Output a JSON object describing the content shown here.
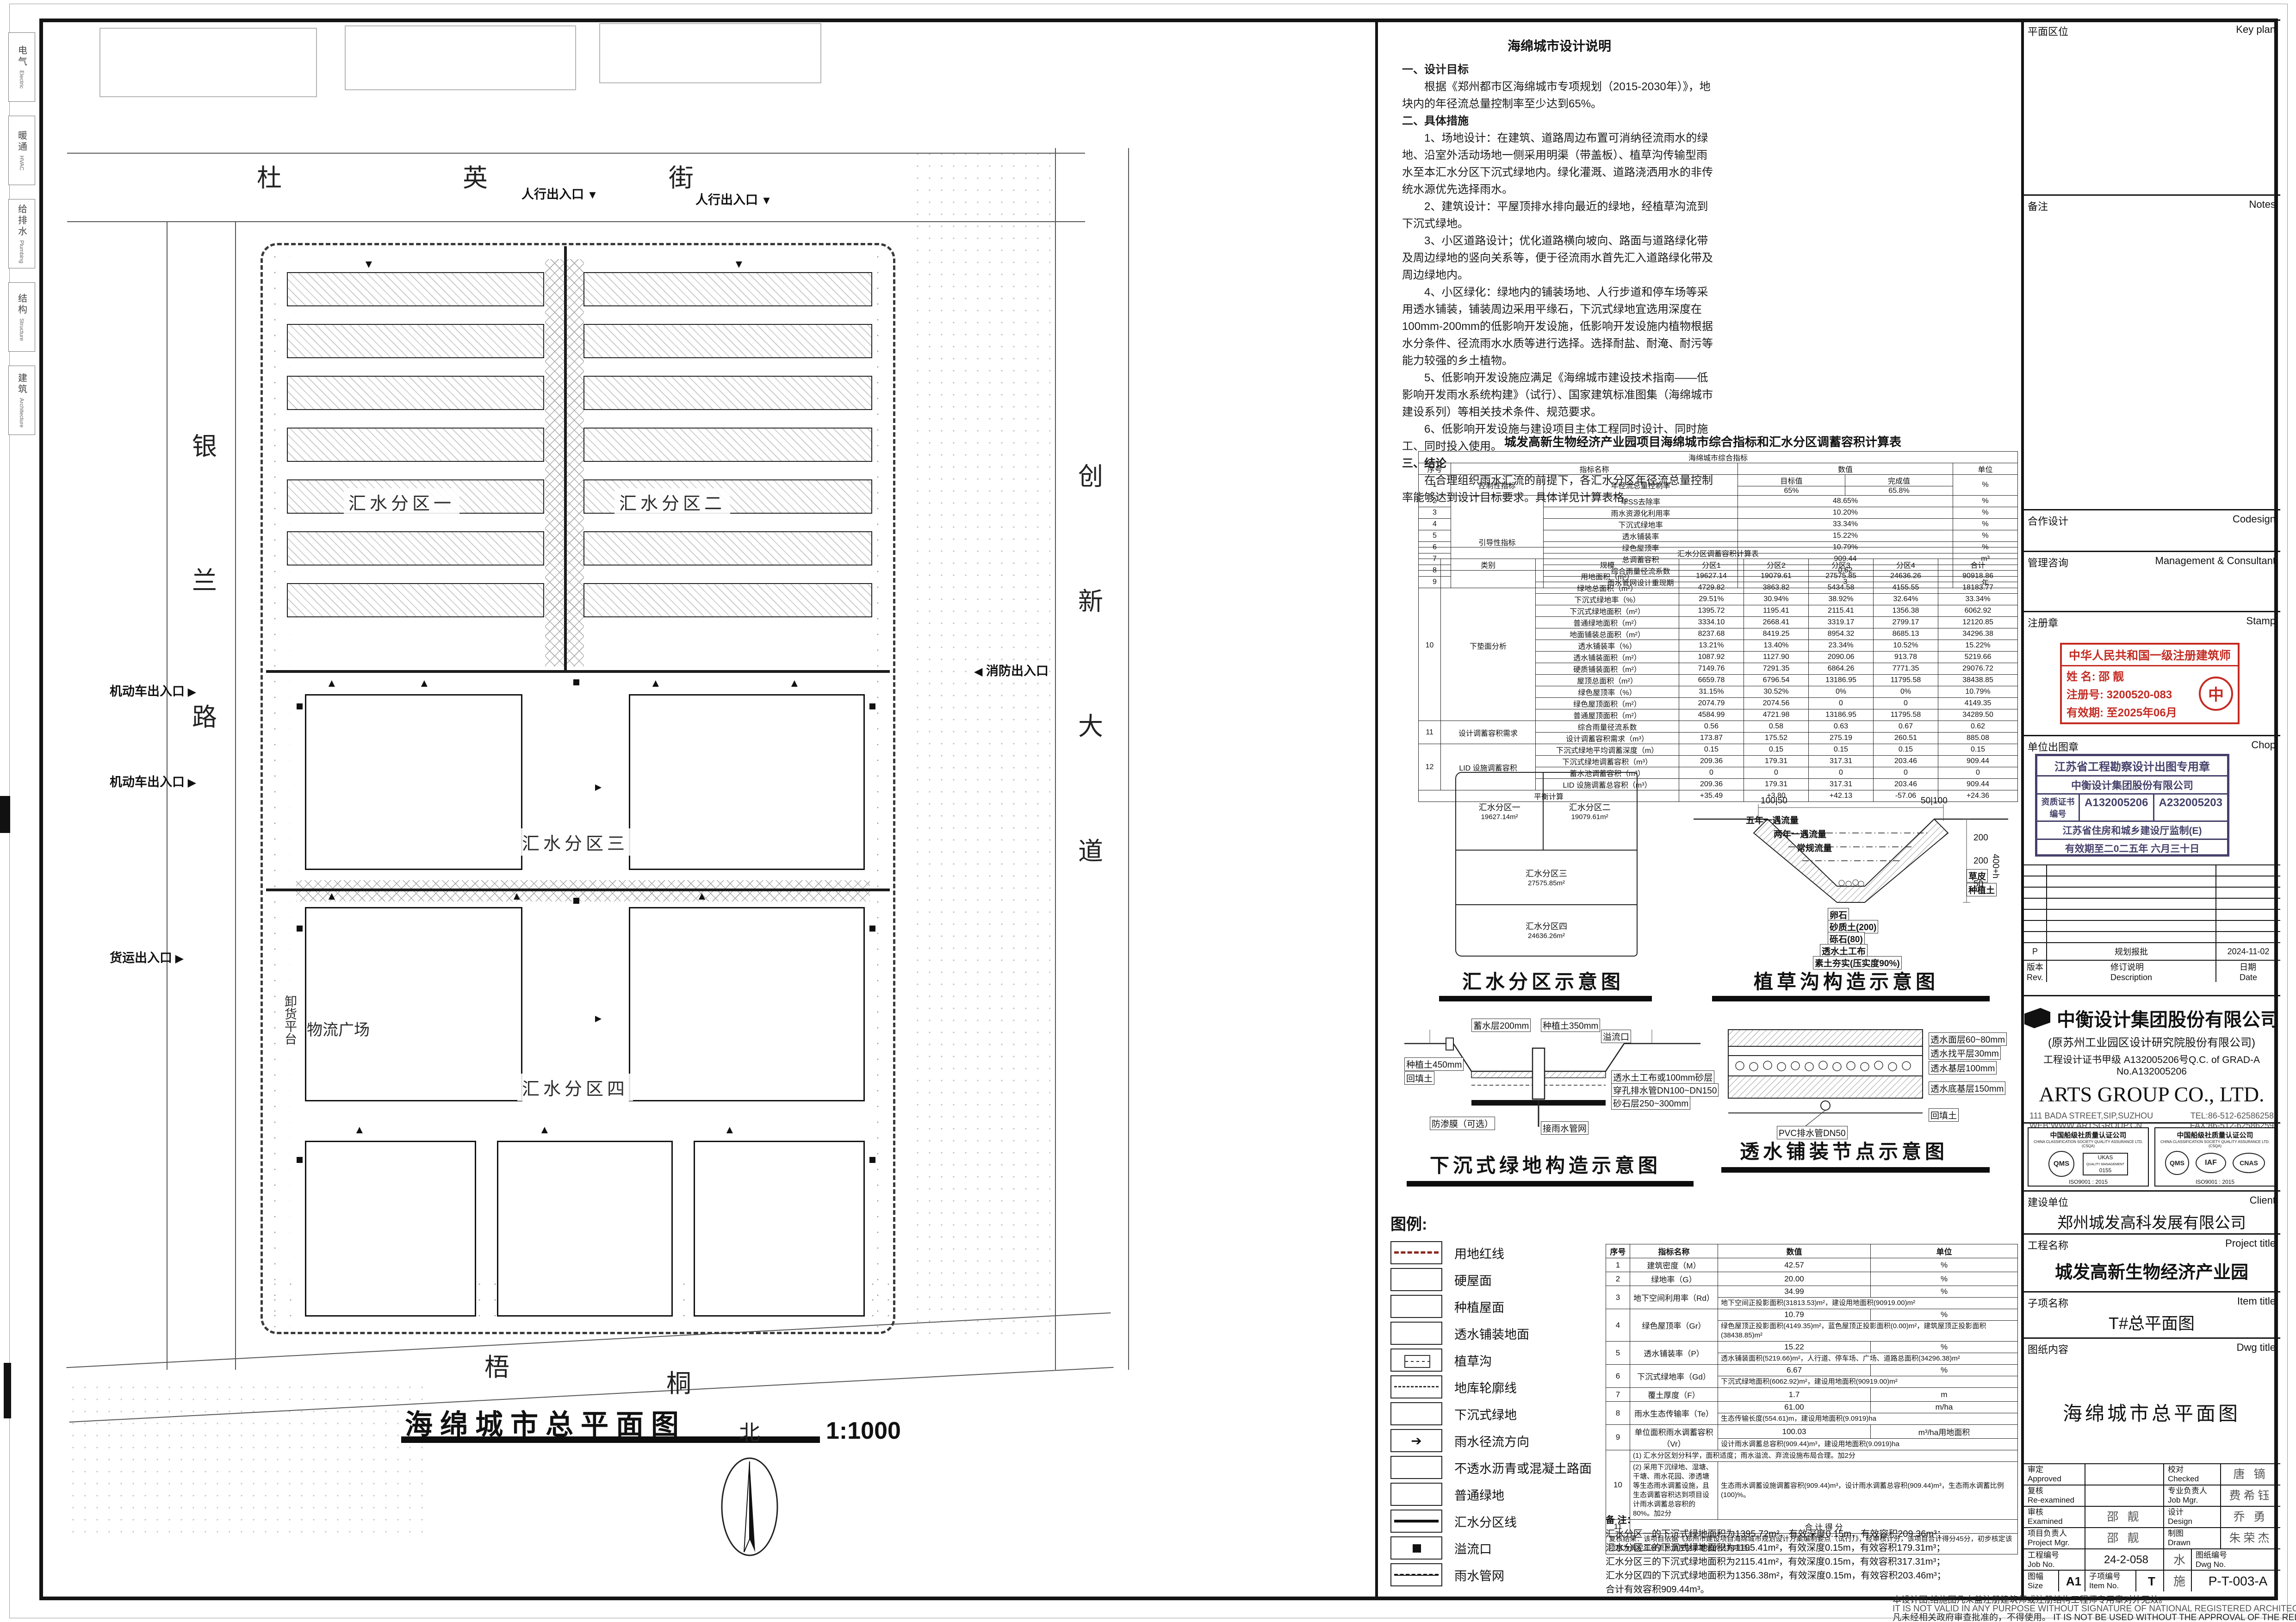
{
  "margin": {
    "disciplines": [
      {
        "cn": "电气",
        "en": "Electric"
      },
      {
        "cn": "暖通",
        "en": "HVAC"
      },
      {
        "cn": "给排水",
        "en": "Plumbing"
      },
      {
        "cn": "结构",
        "en": "Structure"
      },
      {
        "cn": "建筑",
        "en": "Architecture"
      }
    ]
  },
  "plan": {
    "title": "海绵城市总平面图",
    "scale": "1:1000",
    "north": "北",
    "streets": {
      "top": [
        "杜",
        "英",
        "街"
      ],
      "left": [
        "银",
        "兰",
        "路"
      ],
      "right": [
        "创",
        "新",
        "大",
        "道"
      ],
      "bottom": [
        "梧",
        "桐"
      ]
    },
    "zones": [
      "汇水分区一",
      "汇水分区二",
      "汇水分区三",
      "汇水分区四"
    ],
    "site_labels": [
      "物流广场",
      "卸货平台"
    ],
    "entrances": [
      "人行出入口",
      "人行出入口",
      "消防出入口",
      "机动车出入口",
      "机动车出入口",
      "货运出入口"
    ]
  },
  "notes": {
    "title": "海绵城市设计说明",
    "paragraphs": [
      {
        "h": true,
        "text": "一、设计目标"
      },
      {
        "h": false,
        "text": "根据《郑州都市区海绵城市专项规划（2015-2030年）》，地块内的年径流总量控制率至少达到65%。"
      },
      {
        "h": true,
        "text": "二、具体措施"
      },
      {
        "h": false,
        "text": "1、场地设计：在建筑、道路周边布置可消纳径流雨水的绿地、沿室外活动场地一侧采用明渠（带盖板）、植草沟传输型雨水至本汇水分区下沉式绿地内。绿化灌溉、道路浇洒用水的非传统水源优先选择雨水。"
      },
      {
        "h": false,
        "text": "2、建筑设计：平屋顶排水排向最近的绿地，经植草沟流到下沉式绿地。"
      },
      {
        "h": false,
        "text": "3、小区道路设计；优化道路横向坡向、路面与道路绿化带及周边绿地的竖向关系等，便于径流雨水首先汇入道路绿化带及周边绿地内。"
      },
      {
        "h": false,
        "text": "4、小区绿化：绿地内的铺装场地、人行步道和停车场等采用透水铺装，铺装周边采用平缘石，下沉式绿地宜选用深度在100mm-200mm的低影响开发设施，低影响开发设施内植物根据水分条件、径流雨水水质等进行选择。选择耐盐、耐淹、耐污等能力较强的乡土植物。"
      },
      {
        "h": false,
        "text": "5、低影响开发设施应满足《海绵城市建设技术指南——低影响开发雨水系统构建》（试行）、国家建筑标准图集（海绵城市建设系列）等相关技术条件、规范要求。"
      },
      {
        "h": false,
        "text": "6、低影响开发设施与建设项目主体工程同时设计、同时施工、同时投入使用。"
      },
      {
        "h": true,
        "text": "三、结论"
      },
      {
        "h": false,
        "text": "在合理组织雨水汇流的前提下，各汇水分区年径流总量控制率能够达到设计目标要求。具体详见计算表格。"
      }
    ]
  },
  "tables": {
    "main_title": "城发高新生物经济产业园项目海绵城市综合指标和汇水分区调蓄容积计算表",
    "indicator": {
      "section_title": "海绵城市综合指标",
      "headers": [
        "序号",
        "指标名称",
        "数值",
        "单位"
      ],
      "sub_headers": [
        "目标值",
        "完成值"
      ],
      "rows": [
        {
          "no": "1",
          "cat": "控制性指标",
          "name": "年径流总量控制率",
          "target": "65%",
          "done": "65.8%",
          "unit": "%"
        },
        {
          "no": "2",
          "cat": "引导性指标",
          "name": "年SS去除率",
          "value": "48.65%",
          "unit": "%"
        },
        {
          "no": "3",
          "name": "雨水资源化利用率",
          "value": "10.20%",
          "unit": "%"
        },
        {
          "no": "4",
          "name": "下沉式绿地率",
          "value": "33.34%",
          "unit": "%"
        },
        {
          "no": "5",
          "name": "透水铺装率",
          "value": "15.22%",
          "unit": "%"
        },
        {
          "no": "6",
          "name": "绿色屋顶率",
          "value": "10.79%",
          "unit": "%"
        },
        {
          "no": "7",
          "name": "总调蓄容积",
          "value": "909.44",
          "unit": "m³"
        },
        {
          "no": "8",
          "name": "综合雨量径流系数",
          "value": "0.62",
          "unit": "-"
        },
        {
          "no": "9",
          "name": "雨水管网设计重现期",
          "value": "3",
          "unit": "年"
        }
      ]
    },
    "catchment": {
      "section_title": "汇水分区调蓄容积计算表",
      "headers": [
        "",
        "类别",
        "规模",
        "分区1",
        "分区2",
        "分区3",
        "分区4",
        "合计"
      ],
      "groups": [
        {
          "no": "10",
          "cat": "下垫面分析",
          "rows": [
            {
              "name": "用地面积（m²）",
              "v": [
                "19627.14",
                "19079.61",
                "27575.85",
                "24636.26",
                "90918.86"
              ]
            },
            {
              "name": "绿地总面积（m²）",
              "v": [
                "4729.82",
                "3863.82",
                "5434.58",
                "4155.55",
                "18183.77"
              ]
            },
            {
              "name": "下沉式绿地率（%）",
              "v": [
                "29.51%",
                "30.94%",
                "38.92%",
                "32.64%",
                "33.34%"
              ]
            },
            {
              "name": "下沉式绿地面积（m²）",
              "v": [
                "1395.72",
                "1195.41",
                "2115.41",
                "1356.38",
                "6062.92"
              ]
            },
            {
              "name": "普通绿地面积（m²）",
              "v": [
                "3334.10",
                "2668.41",
                "3319.17",
                "2799.17",
                "12120.85"
              ]
            },
            {
              "name": "地面铺装总面积（m²）",
              "v": [
                "8237.68",
                "8419.25",
                "8954.32",
                "8685.13",
                "34296.38"
              ]
            },
            {
              "name": "透水铺装率（%）",
              "v": [
                "13.21%",
                "13.40%",
                "23.34%",
                "10.52%",
                "15.22%"
              ]
            },
            {
              "name": "透水铺装面积（m²）",
              "v": [
                "1087.92",
                "1127.90",
                "2090.06",
                "913.78",
                "5219.66"
              ]
            },
            {
              "name": "硬质铺装面积（m²）",
              "v": [
                "7149.76",
                "7291.35",
                "6864.26",
                "7771.35",
                "29076.72"
              ]
            },
            {
              "name": "屋顶总面积（m²）",
              "v": [
                "6659.78",
                "6796.54",
                "13186.95",
                "11795.58",
                "38438.85"
              ]
            },
            {
              "name": "绿色屋顶率（%）",
              "v": [
                "31.15%",
                "30.52%",
                "0%",
                "0%",
                "10.79%"
              ]
            },
            {
              "name": "绿色屋顶面积（m²）",
              "v": [
                "2074.79",
                "2074.56",
                "0",
                "0",
                "4149.35"
              ]
            },
            {
              "name": "普通屋顶面积（m²）",
              "v": [
                "4584.99",
                "4721.98",
                "13186.95",
                "11795.58",
                "34289.50"
              ]
            }
          ]
        },
        {
          "no": "11",
          "cat": "设计调蓄容积需求",
          "rows": [
            {
              "name": "综合雨量径流系数",
              "v": [
                "0.56",
                "0.58",
                "0.63",
                "0.67",
                "0.62"
              ]
            },
            {
              "name": "设计调蓄容积需求（m³）",
              "v": [
                "173.87",
                "175.52",
                "275.19",
                "260.51",
                "885.08"
              ]
            }
          ]
        },
        {
          "no": "12",
          "cat": "LID 设施调蓄容积",
          "rows": [
            {
              "name": "下沉式绿地平均调蓄深度（m）",
              "v": [
                "0.15",
                "0.15",
                "0.15",
                "0.15",
                "0.15"
              ]
            },
            {
              "name": "下沉式绿地调蓄容积（m³）",
              "v": [
                "209.36",
                "179.31",
                "317.31",
                "203.46",
                "909.44"
              ]
            },
            {
              "name": "蓄水池调蓄容积（m³）",
              "v": [
                "0",
                "0",
                "0",
                "0",
                "0"
              ]
            },
            {
              "name": "LID 设施调蓄总容积（m³）",
              "v": [
                "209.36",
                "179.31",
                "317.31",
                "203.46",
                "909.44"
              ]
            }
          ]
        }
      ],
      "balance": {
        "label": "平衡计算",
        "v": [
          "+35.49",
          "+3.80",
          "+42.13",
          "-57.06",
          "+24.36"
        ]
      }
    }
  },
  "diagrams": {
    "catchment_map": {
      "caption": "汇水分区示意图",
      "zones": [
        {
          "name": "汇水分区一",
          "area": "19627.14m²"
        },
        {
          "name": "汇水分区二",
          "area": "19079.61m²"
        },
        {
          "name": "汇水分区三",
          "area": "27575.85m²"
        },
        {
          "name": "汇水分区四",
          "area": "24636.26m²"
        }
      ]
    },
    "swale": {
      "caption": "植草沟构造示意图",
      "flow_labels": [
        "五年一遇流量",
        "两年一遇流量",
        "常规流量"
      ],
      "layer_labels": [
        "卵石",
        "砂质土(200)",
        "砾石(80)",
        "透水土工布",
        "素土夯实(压实度90%)"
      ],
      "side_labels": [
        "草皮",
        "种植土"
      ],
      "dims": [
        "100",
        "50",
        "50",
        "100",
        "200",
        "200",
        "50",
        "400+h"
      ]
    },
    "sunken": {
      "caption": "下沉式绿地构造示意图",
      "labels": [
        "蓄水层200mm",
        "种植土350mm",
        "溢流口",
        "透水土工布或100mm砂层",
        "穿孔排水管DN100~DN150",
        "砂石层250~300mm",
        "防渗膜（可选）",
        "接雨水管网",
        "种植土450mm",
        "回填土"
      ]
    },
    "paving": {
      "caption": "透水铺装节点示意图",
      "labels": [
        "透水面层60~80mm",
        "透水找平层30mm",
        "透水基层100mm",
        "透水底基层150mm",
        "回填土",
        "PVC排水管DN50"
      ]
    }
  },
  "legend": {
    "title": "图例:",
    "items": [
      {
        "label": "用地红线",
        "swatch": "red-dash"
      },
      {
        "label": "硬屋面",
        "swatch": "plain"
      },
      {
        "label": "种植屋面",
        "swatch": "dots-lite"
      },
      {
        "label": "透水铺装地面",
        "swatch": "xhatch"
      },
      {
        "label": "植草沟",
        "swatch": "swale"
      },
      {
        "label": "地库轮廓线",
        "swatch": "dash-thin"
      },
      {
        "label": "下沉式绿地",
        "swatch": "grass"
      },
      {
        "label": "雨水径流方向",
        "swatch": "arrow"
      },
      {
        "label": "不透水沥青或混凝土路面",
        "swatch": "speck"
      },
      {
        "label": "普通绿地",
        "swatch": "dots"
      },
      {
        "label": "汇水分区线",
        "swatch": "thick-line"
      },
      {
        "label": "溢流口",
        "swatch": "square"
      },
      {
        "label": "雨水管网",
        "swatch": "pipe"
      }
    ]
  },
  "score_table": {
    "headers": [
      "序号",
      "指标名称",
      "数值",
      "单位"
    ],
    "rows": [
      {
        "no": "1",
        "name": "建筑密度（M）",
        "value": "42.57",
        "unit": "%"
      },
      {
        "no": "2",
        "name": "绿地率（G）",
        "value": "20.00",
        "unit": "%"
      },
      {
        "no": "3",
        "name": "地下空间利用率（Rd）",
        "value": "34.99",
        "unit": "%",
        "note": "地下空间正投影面积(31813.53)m²，建设用地面积(90919.00)m²"
      },
      {
        "no": "4",
        "name": "绿色屋顶率（Gr）",
        "value": "10.79",
        "unit": "%",
        "note": "绿色屋顶正投影面积(4149.35)m²，蓝色屋顶正投影面积(0.00)m²，建筑屋顶正投影面积(38438.85)m²"
      },
      {
        "no": "5",
        "name": "透水铺装率（P）",
        "value": "15.22",
        "unit": "%",
        "note": "透水铺装面积(5219.66)m²，人行道、停车场、广场、道路总面积(34296.38)m²"
      },
      {
        "no": "6",
        "name": "下沉式绿地率（Gd）",
        "value": "6.67",
        "unit": "%",
        "note": "下沉式绿地面积(6062.92)m²，建设用地面积(90919.00)m²"
      },
      {
        "no": "7",
        "name": "覆土厚度（F）",
        "value": "1.7",
        "unit": "m"
      },
      {
        "no": "8",
        "name": "雨水生态传输率（Te）",
        "value": "61.00",
        "unit": "m/ha",
        "note": "生态传输长度(554.61)m，建设用地面积(9.0919)ha"
      },
      {
        "no": "9",
        "name": "单位面积雨水调蓄容积（Vr）",
        "value": "100.03",
        "unit": "m³/ha用地面积",
        "note": "设计雨水调蓄总容积(909.44)m³，建设用地面积(9.0919)ha"
      }
    ],
    "row10": {
      "no": "10",
      "item1": "(1) 汇水分区划分科学，面积适度；雨水溢流、弃流设施布局合理。加2分",
      "item2": "(2) 采用下沉绿地、湿塘、干塘、雨水花园、渗透塘等生态雨水调蓄设施，且生态调蓄容积达到项目设计雨水调蓄总容积的80%。加2分",
      "item2_note": "生态雨水调蓄设施调蓄容积(909.44)m³，设计雨水调蓄总容积(909.44)m³，生态雨水调蓄比例(100)%。"
    },
    "row11": {
      "no": "11",
      "label": "合 计 得 分"
    },
    "footer": "复核结果：该项目依据《郑州市建设项目海绵城市规划设计方案编制要点（试行）》，经审核计分，该项目合计得分45分，初步核定该项目为满足年径流总量控制率要求的达标项目。"
  },
  "remarks": {
    "title": "备 注：",
    "lines": [
      "汇水分区一的下沉式绿地面积为1395.72m²，有效深度0.15m，有效容积209.36m³；",
      "汇水分区二的下沉式绿地面积为1195.41m²，有效深度0.15m，有效容积179.31m³；",
      "汇水分区三的下沉式绿地面积为2115.41m²，有效深度0.15m，有效容积317.31m³；",
      "汇水分区四的下沉式绿地面积为1356.38m²，有效深度0.15m，有效容积203.46m³；",
      "合计有效容积909.44m³。"
    ]
  },
  "titleblock": {
    "key_plan": {
      "cn": "平面区位",
      "en": "Key plan"
    },
    "notes_sec": {
      "cn": "备注",
      "en": "Notes"
    },
    "codesign": {
      "cn": "合作设计",
      "en": "Codesign"
    },
    "management": {
      "cn": "管理咨询",
      "en": "Management & Consultant"
    },
    "stamp_sec": {
      "cn": "注册章",
      "en": "Stamp",
      "stamp": {
        "line1": "中华人民共和国一级注册建筑师",
        "name_label": "姓  名:",
        "name": "邵  靓",
        "reg_label": "注册号:",
        "reg": "3200520-083",
        "valid_label": "有效期:",
        "valid": "至2025年06月"
      }
    },
    "chop_sec": {
      "cn": "单位出图章",
      "en": "Chop",
      "stamp": {
        "title": "江苏省工程勘察设计出图专用章",
        "company": "中衡设计集团股份有限公司",
        "cert_label": "资质证书编号",
        "cert1": "A132005206",
        "cert2": "A232005203",
        "authority": "江苏省住房和城乡建设厅监制(E)",
        "validity": "有效期至二0二五年 六月三十日"
      }
    },
    "revision": {
      "header": {
        "rev": "版本 Rev.",
        "desc": "修订说明 Description",
        "date": "日期 Date"
      },
      "rows": [
        {
          "rev": "P",
          "desc": "规划报批",
          "date": "2024-11-02"
        }
      ]
    },
    "company": {
      "name_cn": "中衡设计集团股份有限公司",
      "former": "(原苏州工业园区设计研究院股份有限公司)",
      "cert_line": "工程设计证书甲级 A132005206号Q.C. of GRAD-A No.A132005206",
      "name_en": "ARTS GROUP CO., LTD.",
      "address": "111 BADA STREET,SIP,SUZHOU",
      "web": "WEB:WWW.ARTSGROUP.CN",
      "tel": "TEL:86-512-62586258",
      "fax": "FAX:86-512-62586259"
    },
    "certifications": {
      "header_cn": "中国船级社质量认证公司",
      "header_en": "CHINA CLASSIFICATION SOCIETY QUALITY ASSURANCE LTD.(CSQA)",
      "box1": {
        "logo1": "QMS",
        "logo2": "UKAS",
        "logo2_sub": "QUALITY MANAGEMENT",
        "logo2_no": "0155",
        "footer": "ISO9001 : 2015"
      },
      "box2": {
        "logo1": "QMS",
        "logo2": "IAF",
        "logo3": "CNAS",
        "logo3_sub": "MANAGEMENT SYSTEM CNAS C081M",
        "footer": "ISO9001 : 2015"
      }
    },
    "client": {
      "cn": "建设单位",
      "en": "Client",
      "value": "郑州城发高科发展有限公司"
    },
    "project": {
      "cn": "工程名称",
      "en": "Project title",
      "value": "城发高新生物经济产业园"
    },
    "item": {
      "cn": "子项名称",
      "en": "Item title",
      "value": "T#总平面图"
    },
    "dwg": {
      "cn": "图纸内容",
      "en": "Dwg title",
      "value": "海绵城市总平面图"
    },
    "signatures": {
      "left": [
        {
          "label": "审定 Approved",
          "value": ""
        },
        {
          "label": "复核 Re-examined",
          "value": ""
        },
        {
          "label": "审核 Examined",
          "value": "邵 靓"
        },
        {
          "label": "项目负责人 Project Mgr.",
          "value": "邵 靓"
        }
      ],
      "right": [
        {
          "label": "校对 Checked",
          "value": "唐 镝"
        },
        {
          "label": "专业负责人 Job Mgr.",
          "value": "费希钰"
        },
        {
          "label": "设计 Design",
          "value": "乔 勇"
        },
        {
          "label": "制图 Drawn",
          "value": "朱荣杰"
        }
      ],
      "job_label": "工程编号 Job No.",
      "job_no": "24-2-058",
      "size_label": "图幅 Size",
      "size": "A1",
      "item_no_label": "子项编号 Item No.",
      "item_no": "T",
      "discipline_1": "水",
      "discipline_2": "施",
      "dwg_no_label": "图纸编号 Dwg No.",
      "dwg_no": "P-T-003-A"
    },
    "disclaimer": [
      "本设计图,结施图凡未盖注册建筑师或注册结构工程师专用章对外无效。",
      "IT IS NOT VALID IN ANY PURPOSE WITHOUT SIGNATURE OF NATIONAL REGISTERED ARCHITECT OR STRUCTURE ENGINEER.",
      "凡未经相关政府审查批准的，不得使用。 IT IS NOT BE USED WITHOUT THE APPROVAL OF THE RELEVANT GOVERNMENT"
    ]
  }
}
